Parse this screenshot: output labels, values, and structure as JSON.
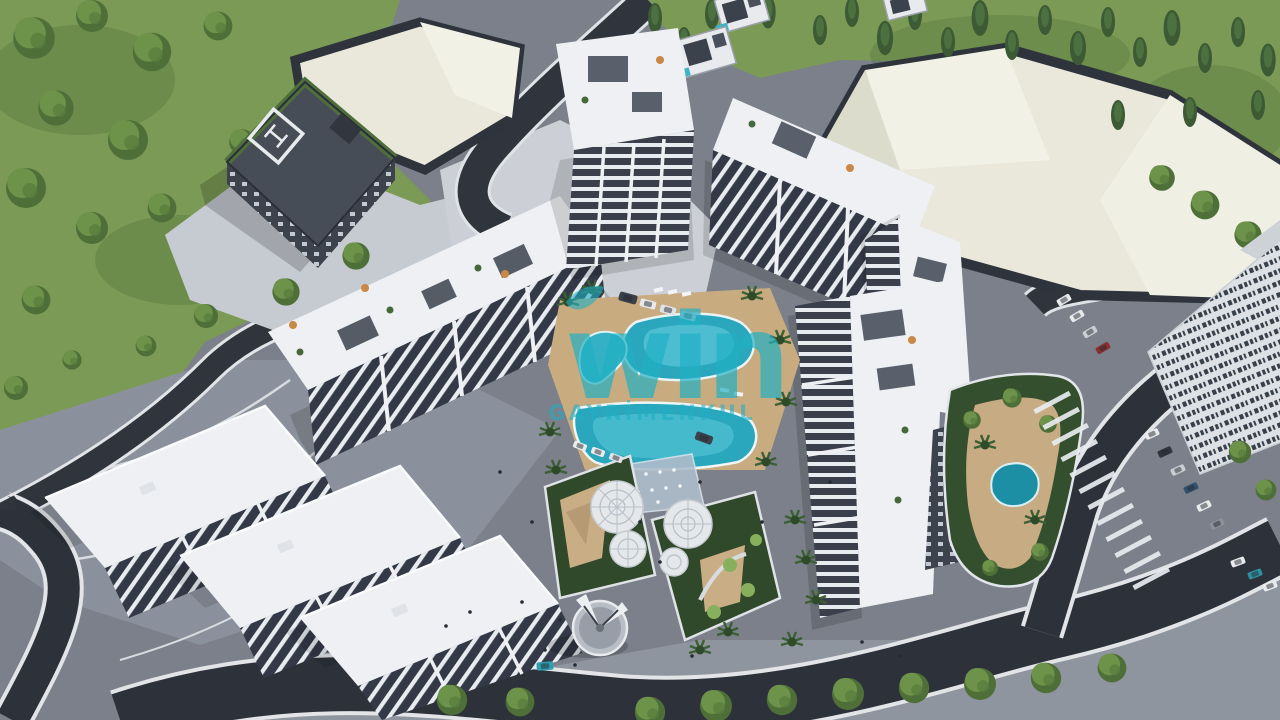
{
  "watermark": {
    "logo_text": "win",
    "subtitle": "GAYRİMENKUL",
    "color": "#1fb0c4"
  },
  "scene": {
    "palette": {
      "grass": "#7a9a55",
      "grass_shade": "#4f6f3a",
      "conifer": "#3c5a34",
      "road_asphalt": "#30343d",
      "pavement": "#7b808a",
      "pavement_light": "#c6cad1",
      "building_white": "#eef0f3",
      "facade_dark": "#343947",
      "warehouse_cream": "#e9e8db",
      "pool_water": "#2aa7bd",
      "deck_tan": "#c9ab80",
      "garden_green": "#30492b",
      "monument_gray": "#b9bec6",
      "helipad_building": "#474d57"
    }
  }
}
